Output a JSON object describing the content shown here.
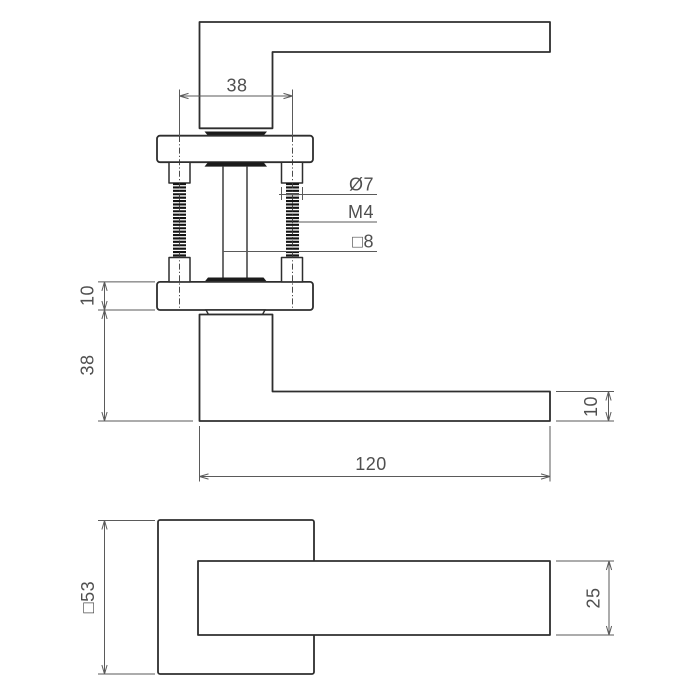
{
  "meta": {
    "type": "technical-drawing",
    "subject": "door lever handle with square rosette, side view and front view"
  },
  "colors": {
    "background": "#ffffff",
    "outline": "#2e2e2e",
    "fill_dark": "#1b1b1b",
    "dimension": "#5a5a5a",
    "text": "#4f4f4f"
  },
  "top_view": {
    "hole_spacing": "38",
    "standoff_diameter": "Ø7",
    "thread_size": "M4",
    "spindle_size": "□8",
    "rosette_thickness": "10",
    "neck_height": "38",
    "lever_length": "120",
    "lever_thickness": "10"
  },
  "front_view": {
    "rosette_size": "□53",
    "lever_width": "25"
  }
}
